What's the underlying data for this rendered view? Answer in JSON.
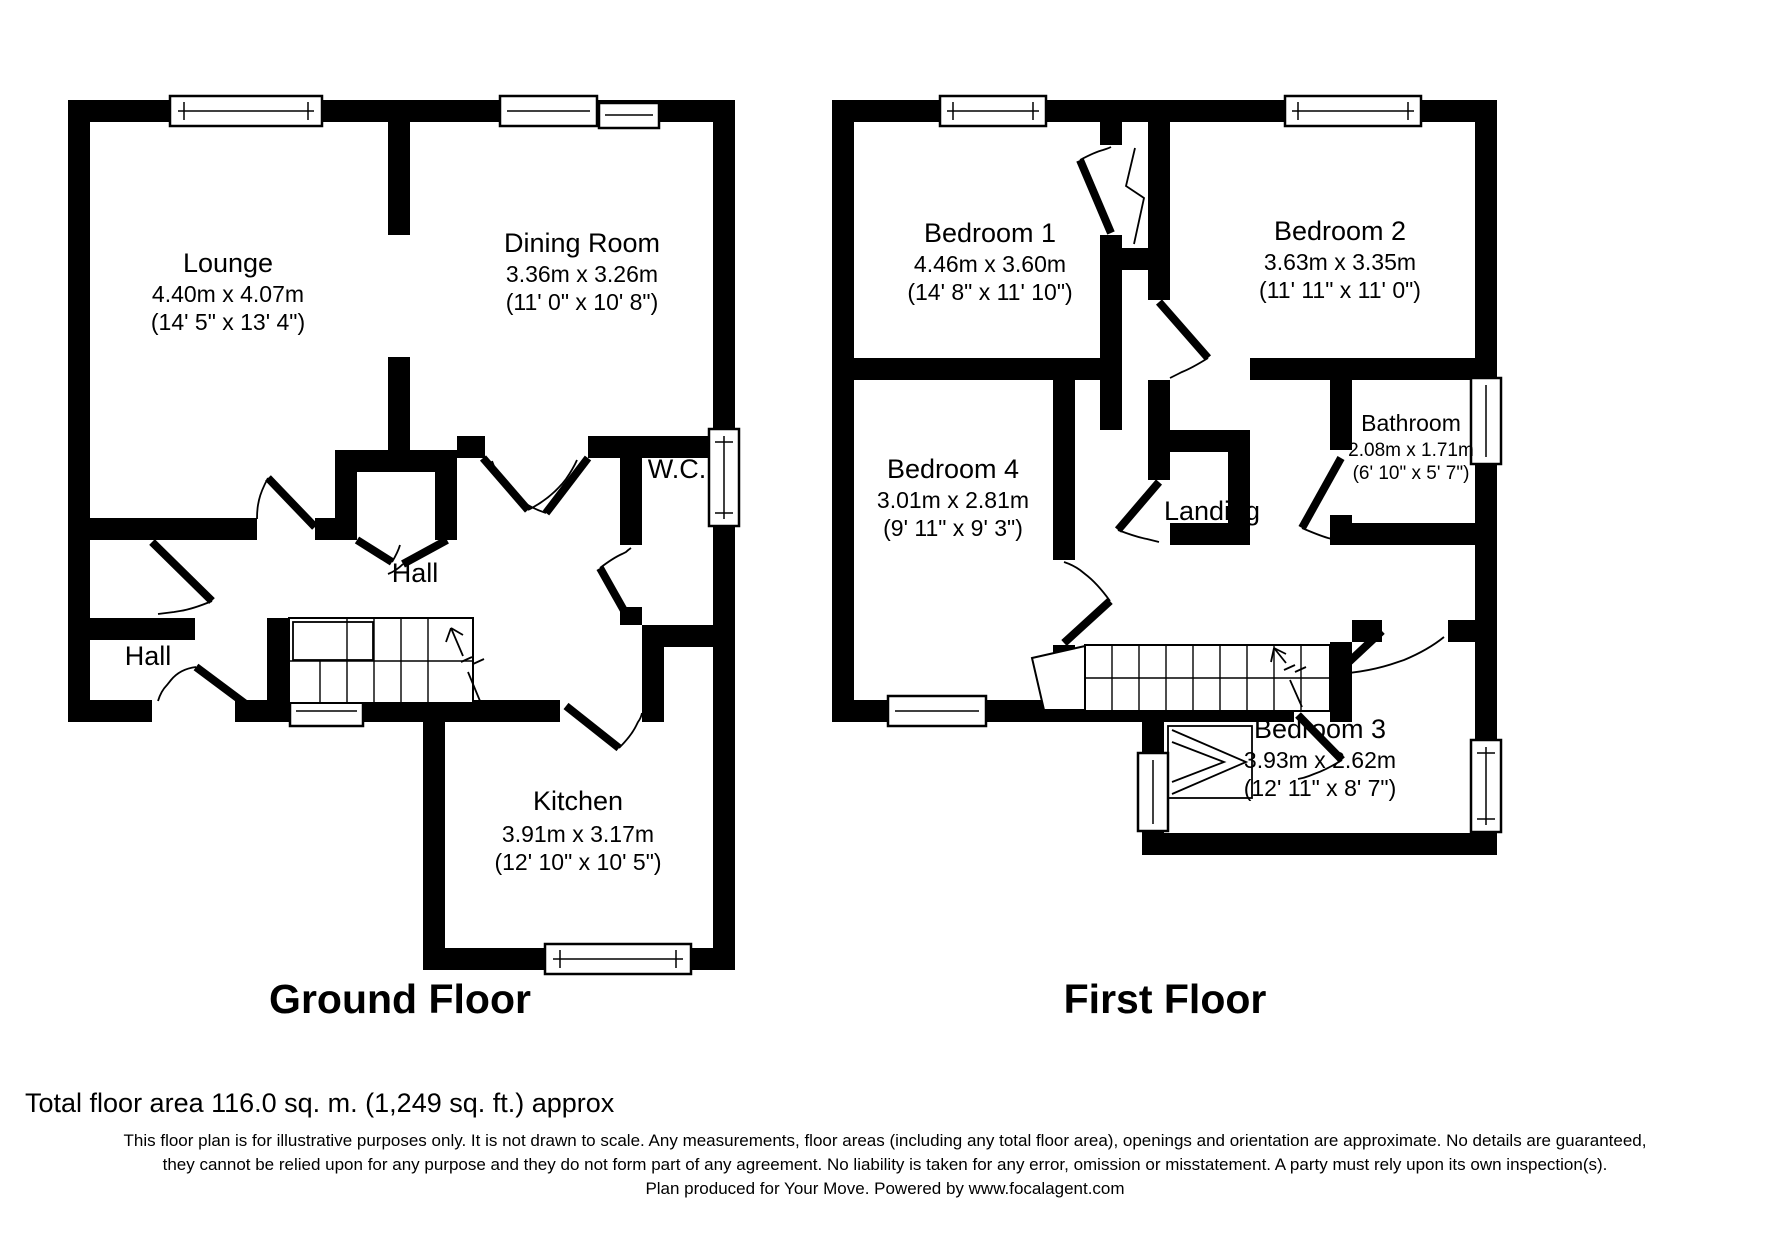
{
  "colors": {
    "wall": "#000000",
    "background": "#ffffff",
    "text": "#000000"
  },
  "ground_floor": {
    "title": "Ground Floor",
    "rooms": {
      "lounge": {
        "name": "Lounge",
        "metric": "4.40m x 4.07m",
        "imperial": "(14' 5\" x 13' 4\")"
      },
      "dining": {
        "name": "Dining Room",
        "metric": "3.36m x 3.26m",
        "imperial": "(11' 0\" x 10' 8\")"
      },
      "wc": {
        "name": "W.C."
      },
      "hall": {
        "name": "Hall"
      },
      "hall2": {
        "name": "Hall"
      },
      "kitchen": {
        "name": "Kitchen",
        "metric": "3.91m x 3.17m",
        "imperial": "(12' 10\" x 10' 5\")"
      }
    }
  },
  "first_floor": {
    "title": "First Floor",
    "rooms": {
      "bedroom1": {
        "name": "Bedroom 1",
        "metric": "4.46m x 3.60m",
        "imperial": "(14' 8\" x 11' 10\")"
      },
      "bedroom2": {
        "name": "Bedroom 2",
        "metric": "3.63m x 3.35m",
        "imperial": "(11' 11\" x 11' 0\")"
      },
      "bedroom4": {
        "name": "Bedroom 4",
        "metric": "3.01m x 2.81m",
        "imperial": "(9' 11\" x 9' 3\")"
      },
      "bathroom": {
        "name": "Bathroom",
        "metric": "2.08m x 1.71m",
        "imperial": "(6' 10\" x 5' 7\")"
      },
      "landing": {
        "name": "Landing"
      },
      "bedroom3": {
        "name": "Bedroom 3",
        "metric": "3.93m x 2.62m",
        "imperial": "(12' 11\" x 8' 7\")"
      }
    }
  },
  "footer": {
    "total_area": "Total floor area 116.0 sq. m. (1,249 sq. ft.) approx",
    "line1": "This floor plan is for illustrative purposes only. It is not drawn to scale. Any measurements, floor areas (including any total floor area), openings and orientation are approximate. No details are guaranteed,",
    "line2": "they cannot be relied upon for any purpose and they do not form part of any agreement. No liability is taken for any error, omission or misstatement. A party must rely upon its own inspection(s).",
    "line3": "Plan produced for Your Move. Powered by www.focalagent.com"
  }
}
